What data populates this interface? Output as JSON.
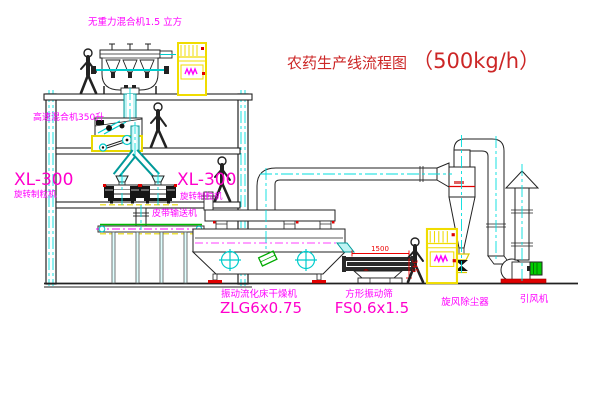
{
  "title": {
    "name": "农药生产线流程图",
    "capacity": "（500kg/h）"
  },
  "equipment_labels": {
    "gravity_free_mixer": "无重力混合机1.5 立方",
    "high_speed_mixer": "高速混合机350升",
    "granulator_left": {
      "model": "XL-300",
      "name": "旋转制粒机"
    },
    "granulator_right": {
      "model": "XL-300",
      "name": "旋转制粒机"
    },
    "belt_conveyor": "皮带输送机",
    "fluid_bed_dryer": {
      "name": "振动流化床干燥机",
      "model": "ZLG6x0.75"
    },
    "vibrating_screen": {
      "name": "方形振动筛",
      "model": "FS0.6x1.5"
    },
    "cyclone_dust_collector": "旋风除尘器",
    "induced_draft_fan": "引风机"
  },
  "dimensions": {
    "screen_length": "1500",
    "screen_height": "345"
  },
  "colors": {
    "label_magenta": "#ff00ff",
    "model_pink": "#ff00cc",
    "title_red": "#cc2626",
    "dimension_red": "#ee0000",
    "cabinet_yellow": "#f0dc00",
    "pipe_cyan": "#00cccc",
    "motor_green": "#00cc00"
  }
}
